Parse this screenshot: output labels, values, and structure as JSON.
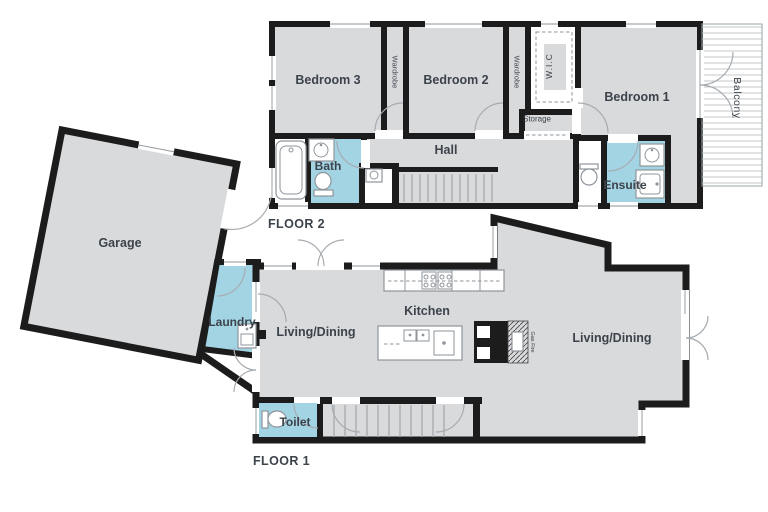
{
  "colors": {
    "wall": "#1c1c1c",
    "room_fill": "#d9dadc",
    "wet_fill": "#a3d4e4",
    "floor_bg": "#ffffff",
    "label_text": "#3c434b",
    "fixture_line": "#8f959b",
    "deck_line": "#c3c7ca",
    "stair_line": "#a6aaae"
  },
  "floor2": {
    "label": "FLOOR 2",
    "rooms": {
      "bedroom3": "Bedroom 3",
      "bedroom2": "Bedroom 2",
      "bedroom1": "Bedroom 1",
      "wardrobe1": "Wardrobe",
      "wardrobe2": "Wardrobe",
      "wic": "W.I.C",
      "storage": "Storage",
      "hall": "Hall",
      "bath": "Bath",
      "ensuite": "Ensuite",
      "balcony": "Balcony"
    }
  },
  "floor1": {
    "label": "FLOOR 1",
    "rooms": {
      "garage": "Garage",
      "laundry": "Laundry",
      "living_dining_left": "Living/Dining",
      "kitchen": "Kitchen",
      "living_dining_right": "Living/Dining",
      "toilet": "Toilet",
      "gas_fire": "Gas Fire"
    }
  }
}
